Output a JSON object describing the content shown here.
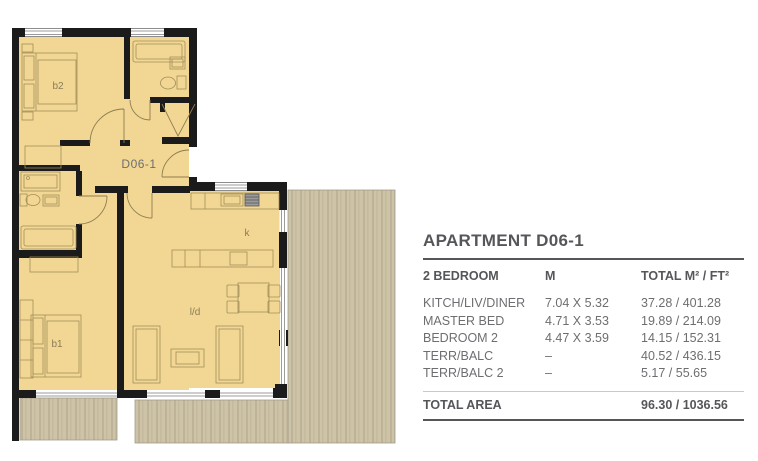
{
  "floor_plan": {
    "labels": {
      "unit": "D06-1",
      "bedroom2": "b2",
      "bedroom1": "b1",
      "kitchen": "k",
      "living_diner": "l/d"
    },
    "colors": {
      "room_fill": "#f2d794",
      "wall": "#1b1b1b",
      "terrace_base": "#cdc3a7",
      "terrace_stripe": "#beb298",
      "furniture_line": "#a28e58"
    }
  },
  "info_panel": {
    "title": "APARTMENT D06-1",
    "columns": [
      "2 BEDROOM",
      "M",
      "TOTAL M² / FT²"
    ],
    "rows": [
      {
        "name": "KITCH/LIV/DINER",
        "dimensions": "7.04 X 5.32",
        "area": "37.28 / 401.28"
      },
      {
        "name": "MASTER BED",
        "dimensions": "4.71 X 3.53",
        "area": "19.89 / 214.09"
      },
      {
        "name": "BEDROOM 2",
        "dimensions": "4.47 X 3.59",
        "area": "14.15 / 152.31"
      },
      {
        "name": "TERR/BALC",
        "dimensions": "–",
        "area": "40.52 / 436.15"
      },
      {
        "name": "TERR/BALC 2",
        "dimensions": "–",
        "area": "5.17 / 55.65"
      }
    ],
    "total": {
      "name": "TOTAL AREA",
      "area": "96.30 / 1036.56"
    },
    "colors": {
      "heading": "#54565a",
      "body": "#6d6e71"
    }
  }
}
